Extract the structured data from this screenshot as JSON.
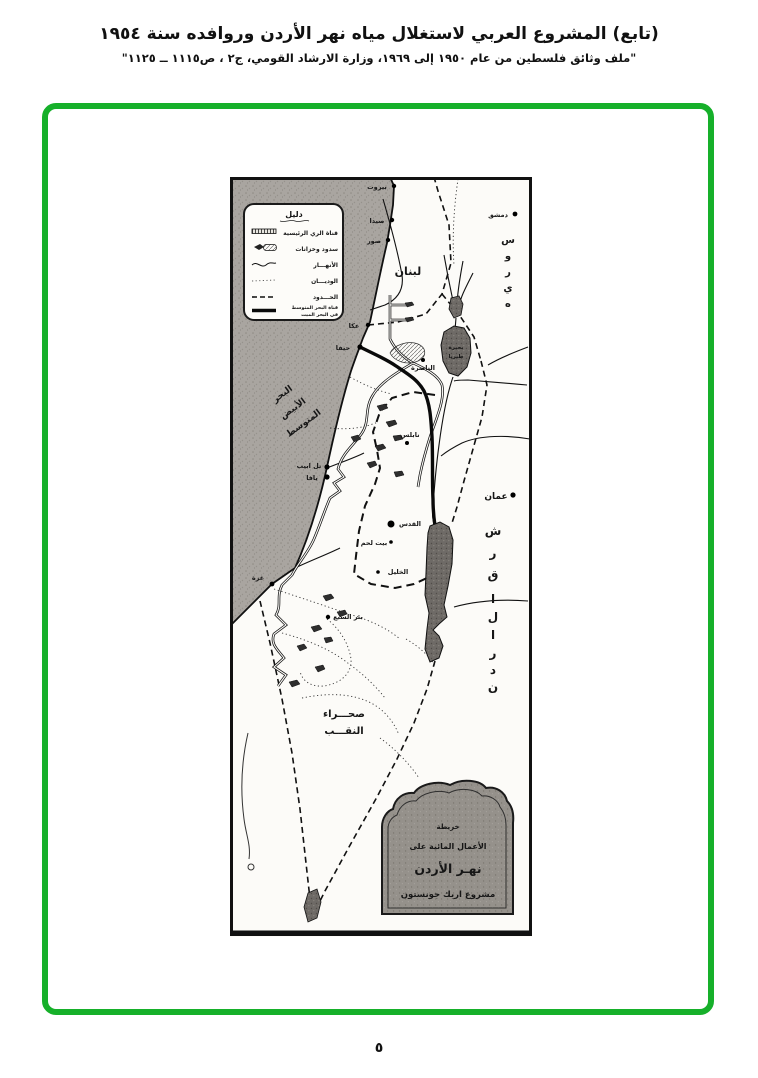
{
  "header": {
    "title": "(تابع) المشروع العربي لاستغلال مياه نهر الأردن وروافده سنة ١٩٥٤",
    "subtitle": "\"ملف وثائق فلسطين من عام ١٩٥٠ إلى ١٩٦٩، وزارة الارشاد القومي، ج٢ ، ص١١١٥ ــ ١١٢٥\""
  },
  "page": {
    "number": "٥"
  },
  "colors": {
    "frame_green": "#16b02a",
    "map_ink": "#1a1a1a",
    "sea_gray": "#a9a5a0",
    "lake_gray": "#6e6a66"
  },
  "map": {
    "legend": {
      "title": "دليل",
      "items": [
        {
          "symbol": "main-irrigation-canal",
          "label": "قناة الري الرئيسية"
        },
        {
          "symbol": "dams-reservoirs",
          "label": "سدود وخزانات"
        },
        {
          "symbol": "rivers",
          "label": "الأنهـــار"
        },
        {
          "symbol": "wadis",
          "label": "الوديـــان"
        },
        {
          "symbol": "borders",
          "label": "الحـــدود"
        },
        {
          "symbol": "mediterranean-dead-sea-canal",
          "label": "قناة البحر المتوسط",
          "label2": "في البحر الميت"
        }
      ]
    },
    "region_labels": {
      "lebanon": "لبنان",
      "syria_word": "سوريه",
      "syria_letters": [
        "س",
        "و",
        "ر",
        "ي",
        "ه"
      ],
      "transjordan_word": "شرق الأردن",
      "transjordan_letters": [
        "ش",
        "ر",
        "ق",
        "ا",
        "ل",
        "ا",
        "ر",
        "د",
        "ن"
      ],
      "mediterranean_lines": [
        "البحر",
        "الأبيض",
        "المتوسط"
      ],
      "negev_lines": [
        "صحـــراء",
        "النقـــب"
      ],
      "tiberias_lines": [
        "بحيرة",
        "طبريا"
      ]
    },
    "cities": [
      {
        "name": "بيروت"
      },
      {
        "name": "صيدا"
      },
      {
        "name": "صور"
      },
      {
        "name": "دمشق"
      },
      {
        "name": "عكا"
      },
      {
        "name": "حيفا"
      },
      {
        "name": "الناصرة"
      },
      {
        "name": "نابلس"
      },
      {
        "name": "تل ابيب"
      },
      {
        "name": "يافا"
      },
      {
        "name": "القدس"
      },
      {
        "name": "بيت لحم"
      },
      {
        "name": "الخليل"
      },
      {
        "name": "غزة"
      },
      {
        "name": "بئر السبع"
      },
      {
        "name": "عمان"
      }
    ],
    "cartouche": {
      "lines": [
        "خريطة",
        "الأعمال المائية على",
        "نهـر الأردن",
        "مشروع اريك جونستون"
      ]
    }
  }
}
